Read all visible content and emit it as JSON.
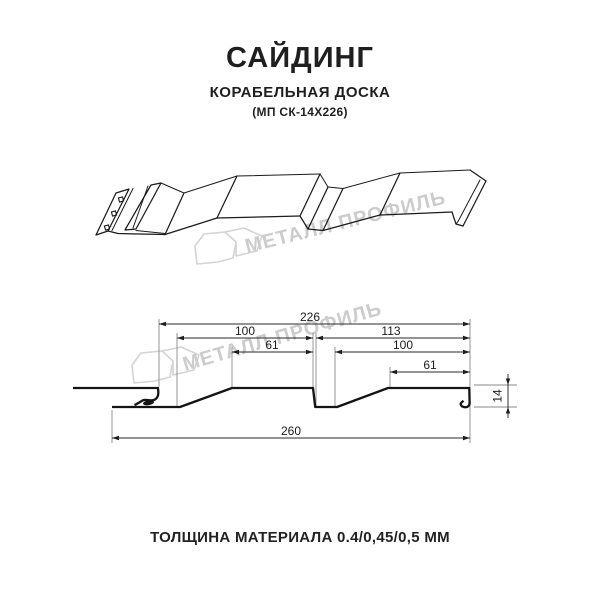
{
  "header": {
    "title": "САЙДИНГ",
    "subtitle": "КОРАБЕЛЬНАЯ ДОСКА",
    "designation": "(МП СК-14Х226)"
  },
  "watermark": {
    "text": "МЕТАЛЛ ПРОФИЛЬ",
    "logo": "metall-profil-logo"
  },
  "dimensions": {
    "top_width": "226",
    "row2_left": "100",
    "row2_right": "113",
    "row3_left": "61",
    "row3_right": "100",
    "row4_right": "61",
    "bottom_width": "260",
    "profile_height": "14"
  },
  "footer": {
    "thickness": "ТОЛЩИНА МАТЕРИАЛА 0.4/0,45/0,5 ММ"
  },
  "colors": {
    "line": "#1b1b1b",
    "dimension": "#2a2a2a",
    "extension": "#8a8a8a",
    "watermark": "#cccccc",
    "text": "#1f1f1f",
    "background": "#ffffff"
  }
}
